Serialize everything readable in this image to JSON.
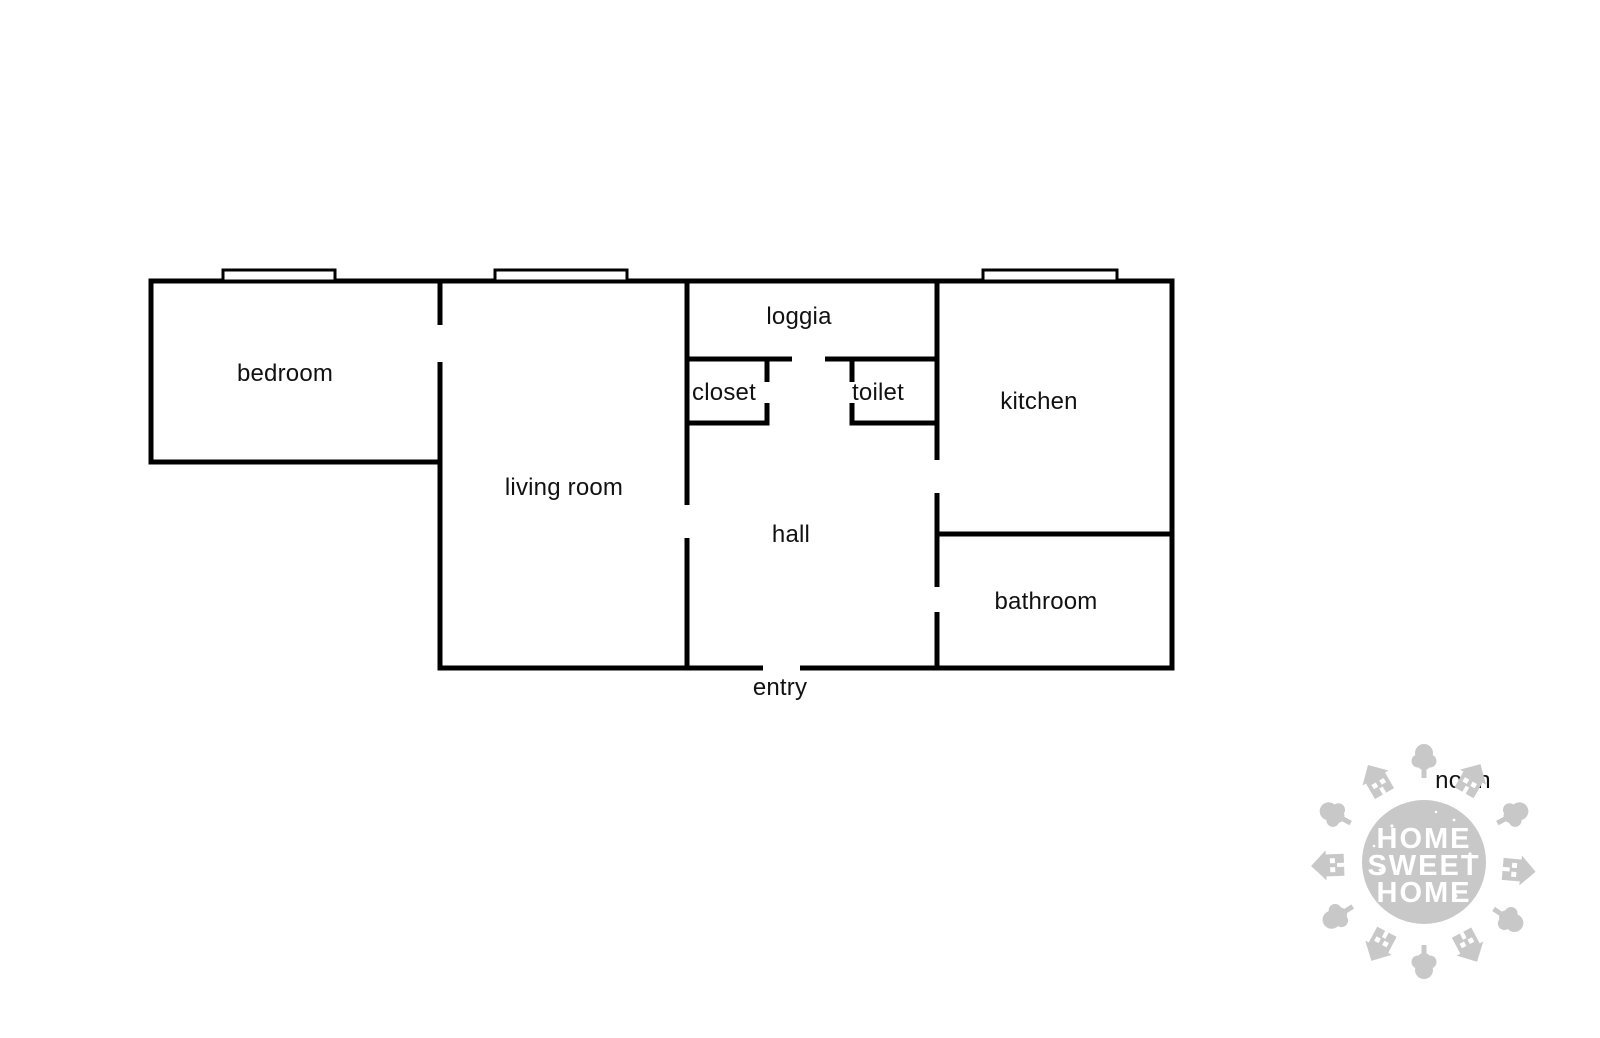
{
  "floor_plan": {
    "rooms": [
      {
        "id": "bedroom",
        "label": "bedroom"
      },
      {
        "id": "living_room",
        "label": "living room"
      },
      {
        "id": "loggia",
        "label": "loggia"
      },
      {
        "id": "closet",
        "label": "closet"
      },
      {
        "id": "toilet",
        "label": "toilet"
      },
      {
        "id": "kitchen",
        "label": "kitchen"
      },
      {
        "id": "hall",
        "label": "hall"
      },
      {
        "id": "bathroom",
        "label": "bathroom"
      },
      {
        "id": "entry",
        "label": "entry"
      }
    ],
    "compass": {
      "label": "north"
    },
    "stamp": {
      "line1": "HOME",
      "line2": "SWEET",
      "line3": "HOME"
    },
    "colors": {
      "wall": "#000000",
      "text": "#111111",
      "stamp_gray": "#c8c8c8",
      "stamp_text": "#ffffff",
      "background": "#ffffff"
    }
  }
}
